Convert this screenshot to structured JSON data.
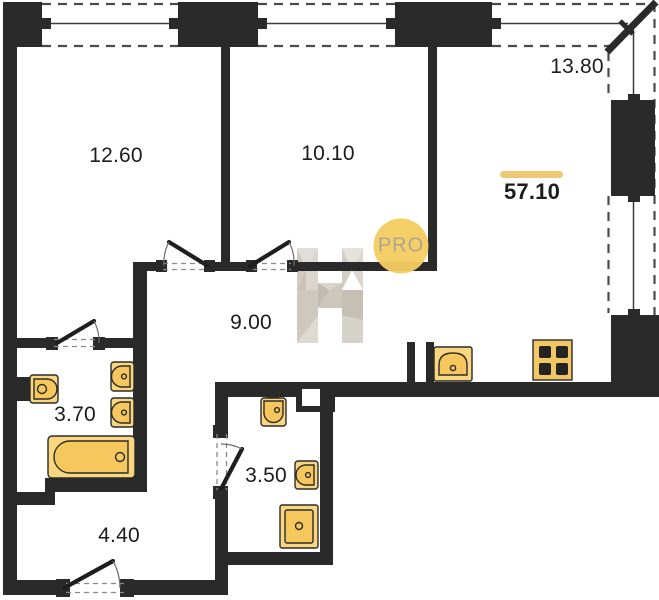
{
  "document": {
    "kind": "apartment floor plan drawing"
  },
  "watermark": {
    "logo_letter": "H",
    "badge_label": "PRO"
  },
  "total_area_label": "57.10",
  "rooms": [
    {
      "name": "bedroom-1",
      "area_label": "12.60"
    },
    {
      "name": "bedroom-2",
      "area_label": "10.10"
    },
    {
      "name": "living-room",
      "area_label": "13.80"
    },
    {
      "name": "hallway",
      "area_label": "9.00"
    },
    {
      "name": "bathroom",
      "area_label": "3.70"
    },
    {
      "name": "toilet-room",
      "area_label": "3.50"
    },
    {
      "name": "entrance-hall",
      "area_label": "4.40"
    }
  ],
  "colors": {
    "wall": "#2a2a2a",
    "fixture_outer": "#FAD77E",
    "fixture_inner": "#F6C75D",
    "accent_bar": "#EFC875",
    "badge_circle": "#F4CC60",
    "background": "#ffffff"
  }
}
